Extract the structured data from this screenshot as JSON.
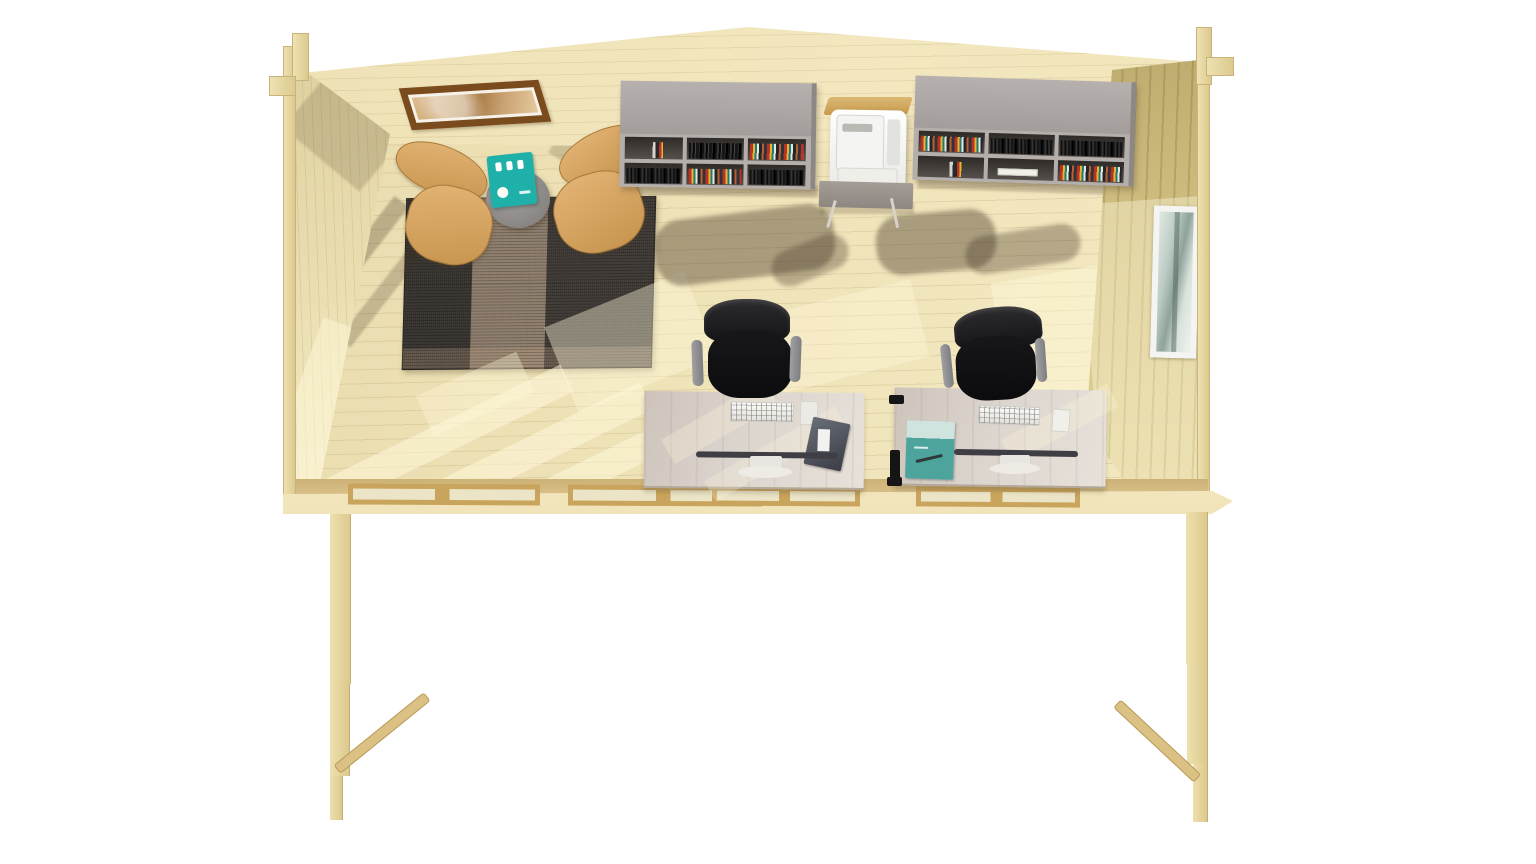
{
  "meta": {
    "title": "Wooden garden office cabin — overhead dollhouse cutaway 3D render",
    "background": "#ffffff"
  },
  "palette": {
    "wood-pale": "#f1e5bb",
    "wood-floor": "#ece0b4",
    "wood-side-wall": "#d3c283",
    "wood-trim": "#c9a45c",
    "frame-brown": "#7a4b1d",
    "shelf-gray": "#aca6a3",
    "teal-accent": "#1fb1a9",
    "chair-wood": "#d8a765",
    "office-chair-black": "#121214",
    "desk-top": "#dcd5ce",
    "window-white": "#f4f4f2",
    "rug-dark": "#37332f",
    "rug-mid": "#8d7c6b"
  },
  "scene": {
    "structure": {
      "back_wall": "gabled rear wall, pale spruce planks",
      "left_wall": "left side wall, interior face in sunlight",
      "right_wall": "right side wall with window",
      "floor": "pale timber plank floor with sun patches",
      "front_cutaway": "front wall removed; window frames visible in plan at the cut",
      "fascia": "front floor edge board",
      "supports": "wall cross-sections extending down as legs with diagonal braces",
      "corner_joints": "interlocking log corner notches"
    },
    "wall_decor": {
      "picture": {
        "label": "framed landscape artwork"
      },
      "side_window": {
        "label": "tall side window, white frame"
      }
    },
    "lounge": {
      "chair_left": {
        "label": "bentwood lounge chair"
      },
      "chair_right": {
        "label": "bentwood lounge chair"
      },
      "side_table": {
        "label": "round grey side table"
      },
      "teal_brochure": {
        "label": "teal brochure with white pictograms"
      },
      "rug": {
        "label": "striped charcoal and taupe rug"
      }
    },
    "storage": {
      "bookshelf_left": {
        "label": "grey wall-mounted bookshelf with books"
      },
      "bookshelf_right": {
        "label": "grey wall-mounted bookshelf with colourful books and papers"
      },
      "printer": {
        "label": "white multifunction printer"
      },
      "printer_stand": {
        "label": "grey printer stand with metal legs"
      }
    },
    "workstations": {
      "desk_left": {
        "label": "whitewashed desk with keyboard, monitor and magazine"
      },
      "desk_right": {
        "label": "whitewashed desk with keyboard, monitor and teal poster"
      },
      "office_chair_left": {
        "label": "black mesh office chair"
      },
      "office_chair_right": {
        "label": "black mesh office chair"
      },
      "desk_clamp": {
        "label": "black edge clamp on right desk"
      }
    }
  }
}
